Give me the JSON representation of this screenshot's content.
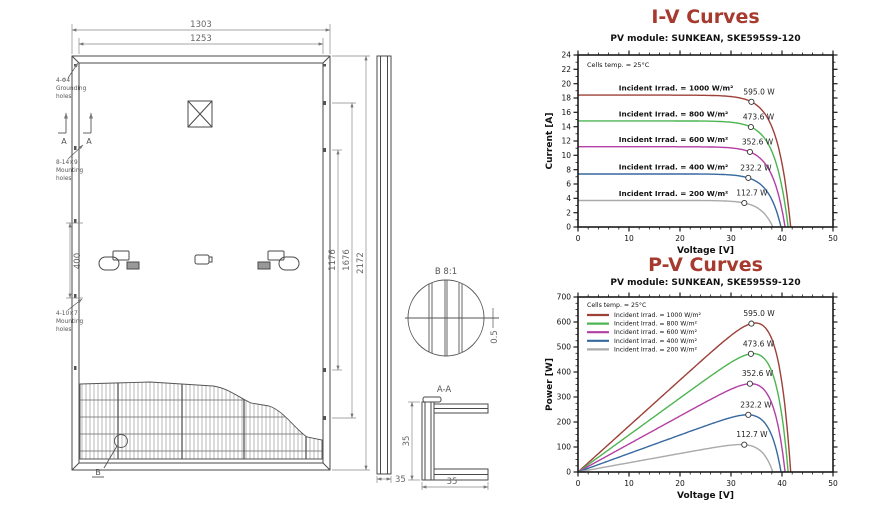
{
  "drawing": {
    "dim_top_outer": "1303",
    "dim_top_inner": "1253",
    "dim_right_inner": "1176",
    "dim_right_mid": "1676",
    "dim_right_outer": "2172",
    "dim_hole_span": "400",
    "dim_side_width": "35",
    "dim_section_height": "35",
    "dim_section_width": "35",
    "dim_detail_gap": "0.5",
    "detail_title": "B 8:1",
    "section_title": "A-A",
    "cut_marker": "A",
    "callout_label": "B",
    "grounding_lines": [
      "4-Φ4",
      "Grounding",
      "holes"
    ],
    "mounting1_lines": [
      "8-14×9",
      "Mounting",
      "holes"
    ],
    "mounting2_lines": [
      "4-10×7",
      "Mounting",
      "holes"
    ]
  },
  "chart_data": {
    "title_color": "#a63a2e",
    "axis_color": "#1a1a1a",
    "series": [
      {
        "label": "Incident Irrad. = 1000 W/m²",
        "color": "#9c4038",
        "isc": 18.4,
        "voc": 41.7,
        "mpp_v": 34.0,
        "mpp_i": 17.4,
        "mpp_p": 595.0,
        "power_label": "595.0 W"
      },
      {
        "label": "Incident Irrad. = 800 W/m²",
        "color": "#4cb552",
        "isc": 14.8,
        "voc": 41.2,
        "mpp_v": 33.9,
        "mpp_i": 13.9,
        "mpp_p": 473.6,
        "power_label": "473.6 W"
      },
      {
        "label": "Incident Irrad. = 600 W/m²",
        "color": "#b33fa5",
        "isc": 11.2,
        "voc": 40.6,
        "mpp_v": 33.7,
        "mpp_i": 10.5,
        "mpp_p": 352.6,
        "power_label": "352.6 W"
      },
      {
        "label": "Incident Irrad. = 400 W/m²",
        "color": "#36689f",
        "isc": 7.4,
        "voc": 39.8,
        "mpp_v": 33.4,
        "mpp_i": 7.0,
        "mpp_p": 232.2,
        "power_label": "232.2 W"
      },
      {
        "label": "Incident Irrad. = 200 W/m²",
        "color": "#aaaaaa",
        "isc": 3.7,
        "voc": 38.2,
        "mpp_v": 32.6,
        "mpp_i": 3.5,
        "mpp_p": 112.7,
        "power_label": "112.7 W"
      }
    ],
    "charts": [
      {
        "id": "iv",
        "kind": "iv",
        "type": "line",
        "title": "I-V Curves",
        "subtitle": "PV module: SUNKEAN, SKE595S9-120",
        "note": "Cells temp. = 25°C",
        "xlabel": "Voltage [V]",
        "ylabel": "Current [A]",
        "xlim": [
          0,
          50
        ],
        "ylim": [
          0,
          24
        ],
        "xmajor": 10,
        "xminor": 2,
        "ymajor": 2,
        "yminor": 1,
        "legend": false,
        "inline_labels": true
      },
      {
        "id": "pv",
        "kind": "pv",
        "type": "line",
        "title": "P-V Curves",
        "subtitle": "PV module: SUNKEAN, SKE595S9-120",
        "note": "Cells temp. = 25°C",
        "xlabel": "Voltage [V]",
        "ylabel": "Power [W]",
        "xlim": [
          0,
          50
        ],
        "ylim": [
          0,
          700
        ],
        "xmajor": 10,
        "xminor": 2,
        "ymajor": 100,
        "yminor": 25,
        "legend": true,
        "inline_labels": false
      }
    ]
  }
}
